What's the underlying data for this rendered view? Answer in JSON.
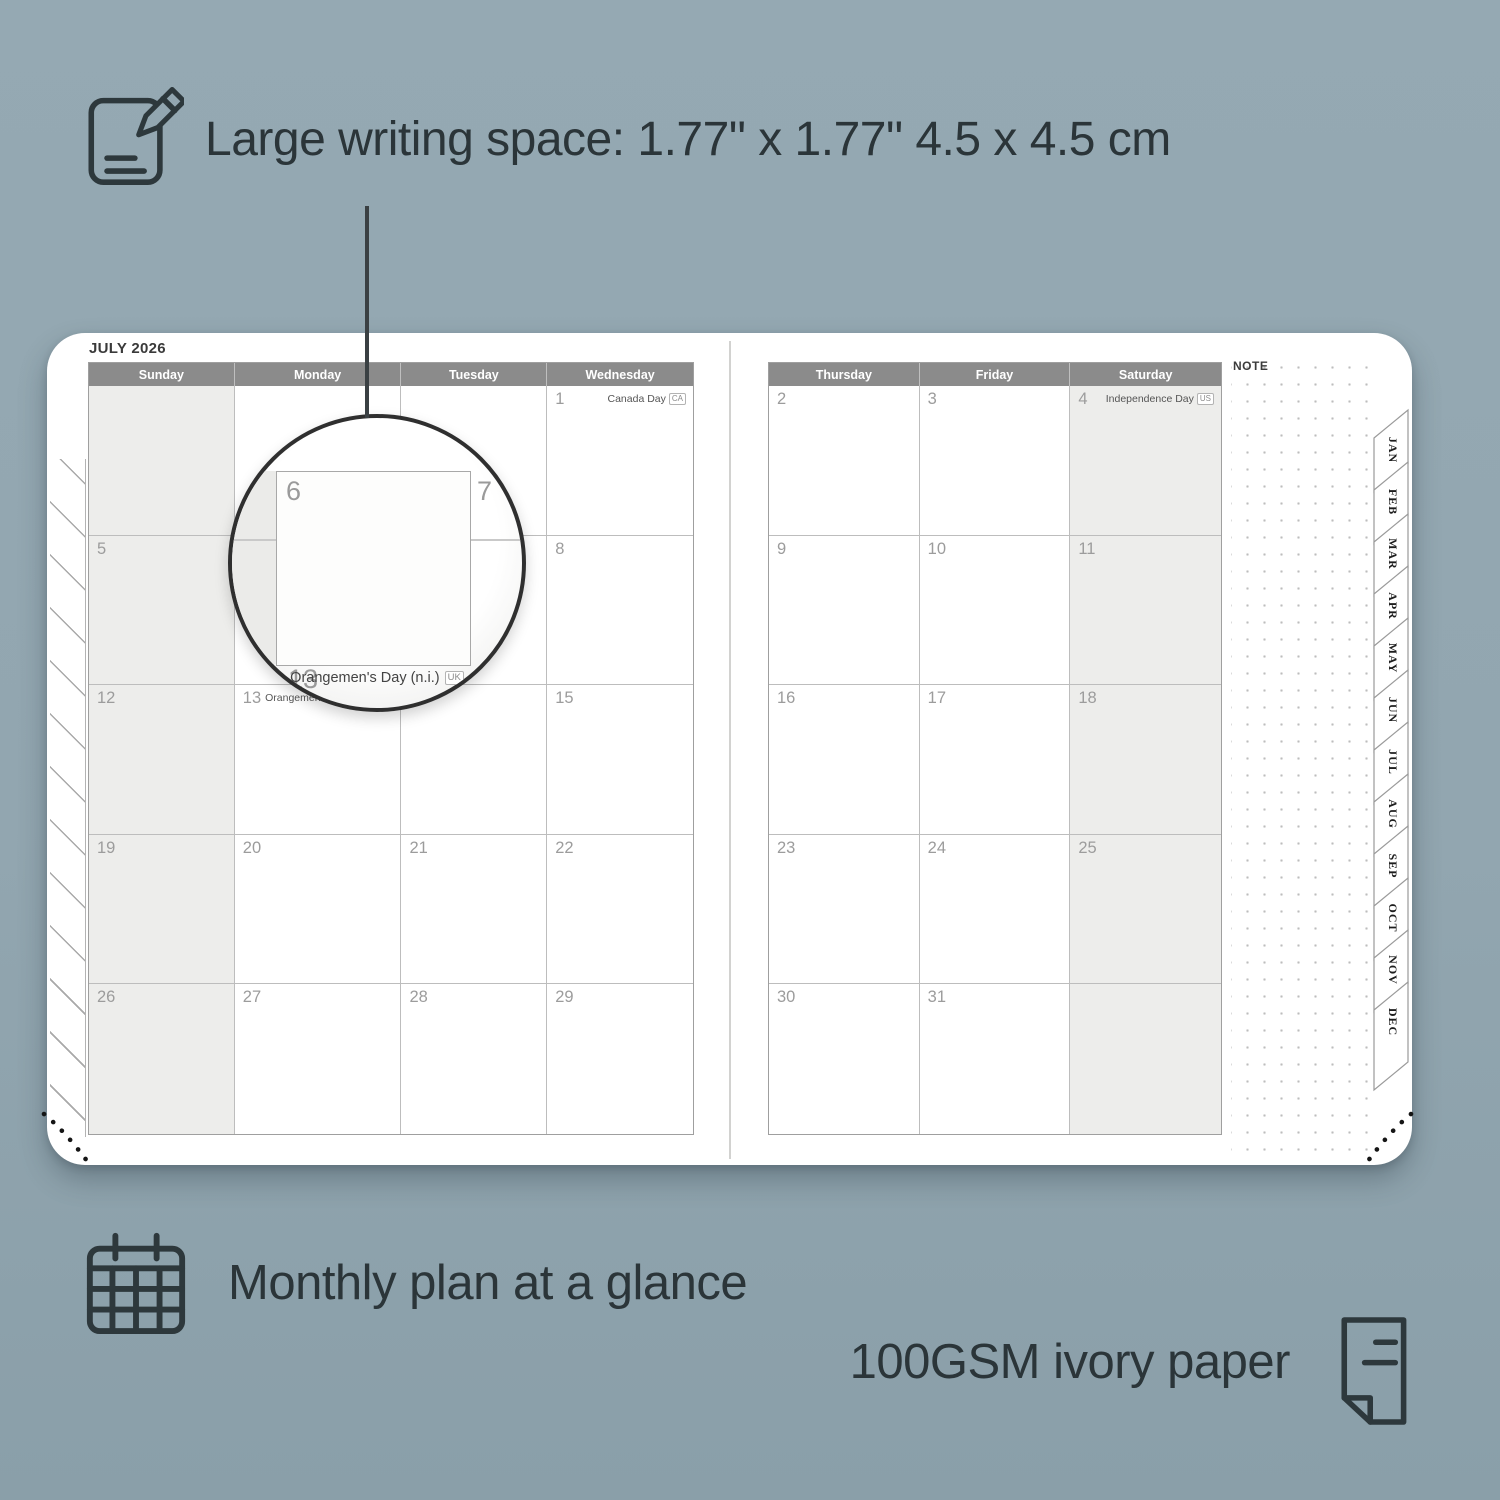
{
  "colors": {
    "background": "#92a6b0",
    "ink": "#2b3539",
    "header_bar": "#8b8b8b",
    "page": "#ffffff",
    "shaded_cell": "#ededeb"
  },
  "annotations": {
    "writing_space": "Large writing space: 1.77\" x 1.77\" 4.5 x 4.5 cm",
    "monthly_plan": "Monthly plan at a glance",
    "paper": "100GSM ivory paper"
  },
  "planner": {
    "title": "JULY 2026",
    "note_label": "NOTE",
    "left_headers": [
      "Sunday",
      "Monday",
      "Tuesday",
      "Wednesday"
    ],
    "right_headers": [
      "Thursday",
      "Friday",
      "Saturday"
    ],
    "left_rows": [
      [
        {
          "day": ""
        },
        {
          "day": ""
        },
        {
          "day": ""
        },
        {
          "day": "1",
          "holiday": "Canada Day",
          "badge": "CA"
        }
      ],
      [
        {
          "day": "5"
        },
        {
          "day": "6"
        },
        {
          "day": "7"
        },
        {
          "day": "8"
        }
      ],
      [
        {
          "day": "12"
        },
        {
          "day": "13",
          "holiday": "Orangemen's Day (n.i.)",
          "badge": "UK"
        },
        {
          "day": "14"
        },
        {
          "day": "15"
        }
      ],
      [
        {
          "day": "19"
        },
        {
          "day": "20"
        },
        {
          "day": "21"
        },
        {
          "day": "22"
        }
      ],
      [
        {
          "day": "26"
        },
        {
          "day": "27"
        },
        {
          "day": "28"
        },
        {
          "day": "29"
        }
      ]
    ],
    "right_rows": [
      [
        {
          "day": "2"
        },
        {
          "day": "3"
        },
        {
          "day": "4",
          "holiday": "Independence Day",
          "badge": "US"
        }
      ],
      [
        {
          "day": "9"
        },
        {
          "day": "10"
        },
        {
          "day": "11"
        }
      ],
      [
        {
          "day": "16"
        },
        {
          "day": "17"
        },
        {
          "day": "18"
        }
      ],
      [
        {
          "day": "23"
        },
        {
          "day": "24"
        },
        {
          "day": "25"
        }
      ],
      [
        {
          "day": "30"
        },
        {
          "day": "31"
        },
        {
          "day": ""
        }
      ]
    ],
    "month_tabs": [
      "JAN",
      "FEB",
      "MAR",
      "APR",
      "MAY",
      "JUN",
      "JUL",
      "AUG",
      "SEP",
      "OCT",
      "NOV",
      "DEC"
    ]
  },
  "magnifier": {
    "day_large": "6",
    "day_next": "7",
    "day_below": "13",
    "holiday_text": "Orangemen's Day (n.i.)",
    "badge": "UK"
  }
}
